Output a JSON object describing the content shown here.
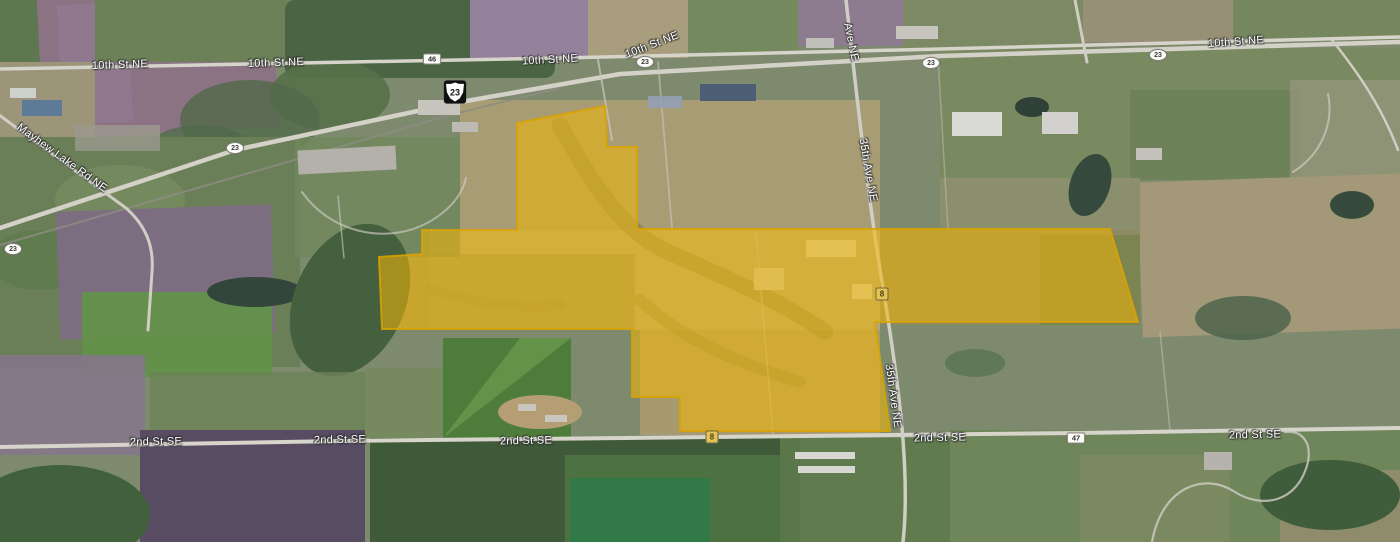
{
  "map": {
    "road_labels": [
      {
        "text": "10th St NE",
        "x": 120,
        "y": 65,
        "rotate": -2
      },
      {
        "text": "10th St NE",
        "x": 276,
        "y": 63,
        "rotate": -2
      },
      {
        "text": "10th St NE",
        "x": 550,
        "y": 60,
        "rotate": -3
      },
      {
        "text": "10th St NE",
        "x": 652,
        "y": 45,
        "rotate": -21
      },
      {
        "text": "10th St NE",
        "x": 1236,
        "y": 42,
        "rotate": -4
      },
      {
        "text": "Mayhew Lake Rd NE",
        "x": 62,
        "y": 158,
        "rotate": 36
      },
      {
        "text": "Ave NE",
        "x": 851,
        "y": 42,
        "rotate": 78
      },
      {
        "text": "35th Ave NE",
        "x": 868,
        "y": 170,
        "rotate": 80
      },
      {
        "text": "35th Ave NE",
        "x": 893,
        "y": 396,
        "rotate": 82
      },
      {
        "text": "2nd St SE",
        "x": 156,
        "y": 442,
        "rotate": -1
      },
      {
        "text": "2nd St SE",
        "x": 340,
        "y": 440,
        "rotate": -1
      },
      {
        "text": "2nd St SE",
        "x": 526,
        "y": 441,
        "rotate": -1
      },
      {
        "text": "2nd St SE",
        "x": 940,
        "y": 438,
        "rotate": -1
      },
      {
        "text": "2nd St SE",
        "x": 1255,
        "y": 435,
        "rotate": -1
      }
    ],
    "route_shields": [
      {
        "style": "us",
        "text": "23",
        "x": 455,
        "y": 92
      },
      {
        "style": "rect",
        "text": "46",
        "x": 432,
        "y": 59
      },
      {
        "style": "oval",
        "text": "23",
        "x": 235,
        "y": 148
      },
      {
        "style": "oval",
        "text": "23",
        "x": 13,
        "y": 249
      },
      {
        "style": "oval",
        "text": "23",
        "x": 645,
        "y": 62
      },
      {
        "style": "oval",
        "text": "23",
        "x": 931,
        "y": 63
      },
      {
        "style": "oval",
        "text": "23",
        "x": 1158,
        "y": 55
      },
      {
        "style": "rect",
        "text": "47",
        "x": 1076,
        "y": 438
      },
      {
        "style": "sq",
        "text": "8",
        "x": 882,
        "y": 294
      },
      {
        "style": "sq",
        "text": "8",
        "x": 712,
        "y": 437
      }
    ],
    "parcel_overlay": {
      "points": "517,123 605,106 607,147 637,147 637,229 1110,229 1138,322 875,322 890,431 680,431 680,397 632,397 632,329 382,329 379,257 422,254 422,230 517,230",
      "fill": "#F2B705",
      "fill_opacity": "0.55",
      "stroke": "#D9A300",
      "stroke_opacity": "0.85"
    }
  }
}
